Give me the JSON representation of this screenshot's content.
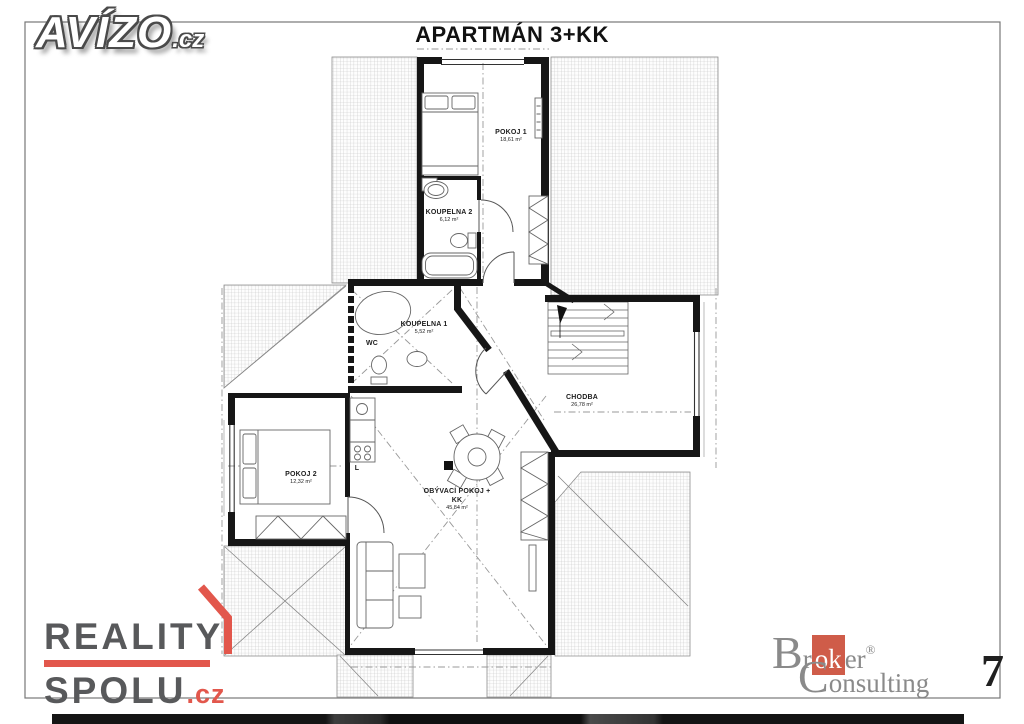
{
  "title": "APARTMÁN 3+KK",
  "rooms": {
    "pokoj1": {
      "name": "POKOJ 1",
      "area": "18,61 m²"
    },
    "koupelna2": {
      "name": "KOUPELNA 2",
      "area": "6,12 m²"
    },
    "koupelna1": {
      "name": "KOUPELNA 1",
      "area": "5,52 m²"
    },
    "wc": {
      "name": "WC"
    },
    "chodba": {
      "name": "CHODBA",
      "area": "26,78 m²"
    },
    "pokoj2": {
      "name": "POKOJ 2",
      "area": "12,32 m²"
    },
    "obyvaci": {
      "name": "OBÝVACÍ POKOJ +",
      "name2": "KK",
      "area": "45,84 m²"
    },
    "kuchyn": {
      "name": "L"
    }
  },
  "logos": {
    "avizo": {
      "text": "AVÍZO",
      "tld": ".cz"
    },
    "reality_spolu": {
      "line1": "REALITY",
      "line2": "SPOLU",
      "tld": ".cz"
    },
    "broker_consulting": {
      "b": "B",
      "r": "r",
      "ok": "ok",
      "er": "er",
      "reg": "®",
      "c": "C",
      "onsulting": "onsulting",
      "number": "7"
    }
  },
  "colors": {
    "reality_red": "#e2574c",
    "broker_red": "#cf5c49",
    "logo_gray": "#8a8a8a",
    "wall_black": "#161616"
  }
}
